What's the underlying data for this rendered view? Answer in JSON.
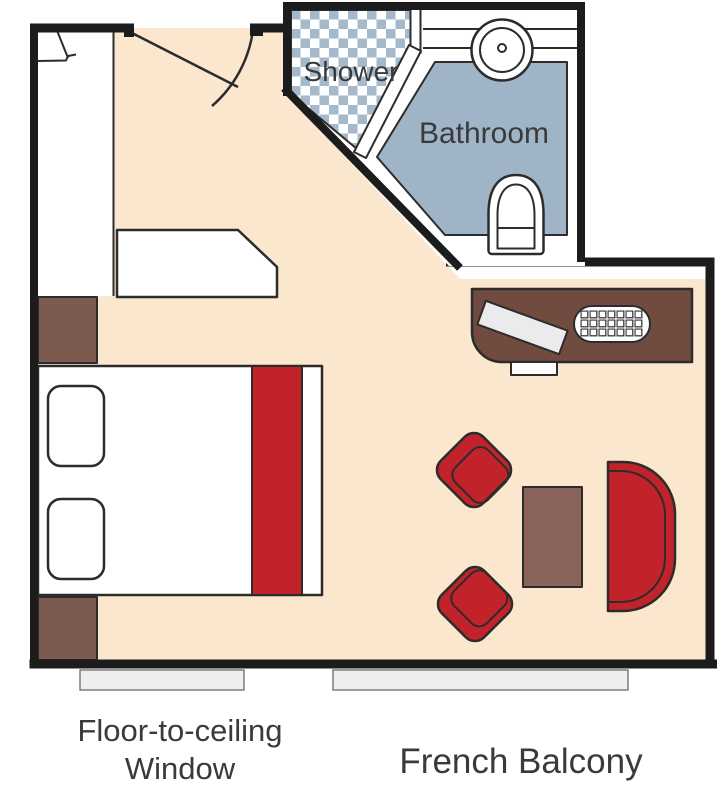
{
  "labels": {
    "shower": "Shower",
    "bathroom": "Bathroom",
    "window_line1": "Floor-to-ceiling",
    "window_line2": "Window",
    "balcony": "French Balcony"
  },
  "colors": {
    "white": "#ffffff",
    "wall": "#1c1c1c",
    "outline": "#2c2c2c",
    "floor": "#fbe6ce",
    "checker_blue": "#a5b9cb",
    "bath_floor": "#9fb4c6",
    "accent_red": "#c2232a",
    "wood_desk": "#6f4b40",
    "wood_nightstand": "#7d5a50",
    "wood_table": "#8a635a",
    "glass_gray": "#eceef0",
    "glass_border": "#7e7e7e",
    "paper": "#ebebed",
    "text": "#3a3a3a"
  }
}
